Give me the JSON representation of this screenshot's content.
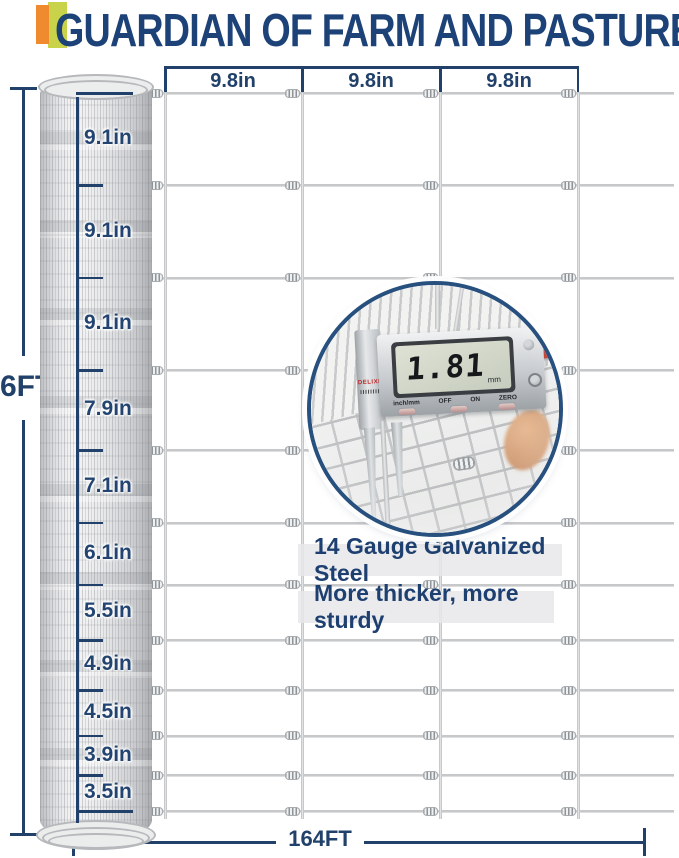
{
  "header": {
    "title": "GUARDIAN OF FARM AND PASTURE"
  },
  "top_dim": {
    "labels": [
      "9.8in",
      "9.8in",
      "9.8in"
    ]
  },
  "side_dim": {
    "labels": [
      "9.1in",
      "9.1in",
      "9.1in",
      "7.9in",
      "7.1in",
      "6.1in",
      "5.5in",
      "4.9in",
      "4.5in",
      "3.9in",
      "3.5in"
    ]
  },
  "height_dim": {
    "label": "6FT"
  },
  "length_dim": {
    "label": "164FT"
  },
  "fence": {
    "rows_in": [
      9.1,
      9.1,
      9.1,
      7.9,
      7.1,
      6.1,
      5.5,
      4.9,
      4.5,
      3.9,
      3.5
    ],
    "cols_in": [
      9.8,
      9.8,
      9.8
    ]
  },
  "inset": {
    "reading": "1.81",
    "unit": "mm",
    "button_labels": [
      "inch/mm",
      "OFF",
      "ON",
      "ZERO"
    ],
    "brand": "DELIXI"
  },
  "features": {
    "line1": "14 Gauge Galvanized Steel",
    "line2": "More thicker, more sturdy"
  },
  "colors": {
    "navy": "#21416b",
    "title_navy": "#1c4278",
    "wire_gray": "#c7c8ca",
    "accent_orange": "#ef8a2f",
    "accent_green": "#c8d34a"
  }
}
